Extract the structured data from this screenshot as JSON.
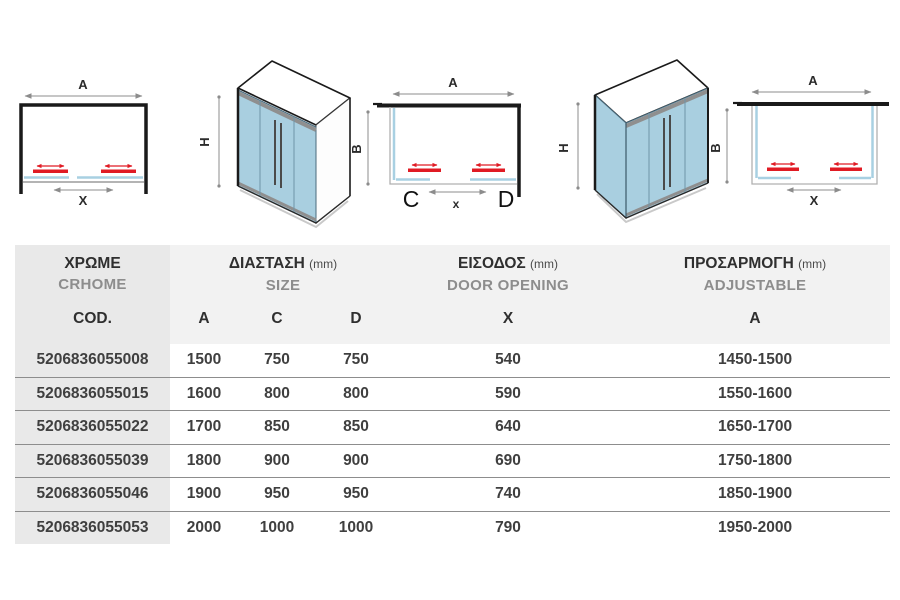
{
  "colors": {
    "glass_blue": "#a9cfe0",
    "glass_line_blue": "#a8d0e2",
    "accent_red": "#e01b24",
    "frame_dark": "#1a1a1a",
    "dim_gray": "#8c8c8c",
    "header_bg": "#f2f2f2",
    "cod_col_bg": "#e9e9e9",
    "row_line": "#8d8d8d",
    "text_dark": "#2f2f2f",
    "text_gray": "#8d8d8d",
    "value_text": "#3f3f3f"
  },
  "diagrams": {
    "plan_left": {
      "width_label": "A",
      "opening_label": "X"
    },
    "iso_front": {
      "height_label": "H",
      "depth_label": "B"
    },
    "plan_center": {
      "width_label": "A",
      "opening_label": "x",
      "fixed_left_label": "C",
      "fixed_right_label": "D"
    },
    "iso_corner": {
      "height_label": "H",
      "depth_label": "B"
    },
    "plan_right": {
      "width_label": "A",
      "opening_label": "X"
    }
  },
  "table": {
    "columns": {
      "color": {
        "title": "ΧΡΩΜΕ",
        "subtitle": "CRHOME",
        "sub_label": "COD."
      },
      "size": {
        "title": "ΔΙΑΣΤΑΣΗ",
        "unit": "(mm)",
        "subtitle": "SIZE",
        "sub_labels": [
          "A",
          "C",
          "D"
        ]
      },
      "door_opening": {
        "title": "ΕΙΣΟΔΟΣ",
        "unit": "(mm)",
        "subtitle": "DOOR OPENING",
        "sub_label": "X"
      },
      "adjustable": {
        "title": "ΠΡΟΣΑΡΜΟΓΗ",
        "unit": "(mm)",
        "subtitle": "ADJUSTABLE",
        "sub_label": "A"
      }
    },
    "rows": [
      {
        "cod": "5206836055008",
        "a": "1500",
        "c": "750",
        "d": "750",
        "x": "540",
        "adjustable": "1450-1500"
      },
      {
        "cod": "5206836055015",
        "a": "1600",
        "c": "800",
        "d": "800",
        "x": "590",
        "adjustable": "1550-1600"
      },
      {
        "cod": "5206836055022",
        "a": "1700",
        "c": "850",
        "d": "850",
        "x": "640",
        "adjustable": "1650-1700"
      },
      {
        "cod": "5206836055039",
        "a": "1800",
        "c": "900",
        "d": "900",
        "x": "690",
        "adjustable": "1750-1800"
      },
      {
        "cod": "5206836055046",
        "a": "1900",
        "c": "950",
        "d": "950",
        "x": "740",
        "adjustable": "1850-1900"
      },
      {
        "cod": "5206836055053",
        "a": "2000",
        "c": "1000",
        "d": "1000",
        "x": "790",
        "adjustable": "1950-2000"
      }
    ]
  }
}
